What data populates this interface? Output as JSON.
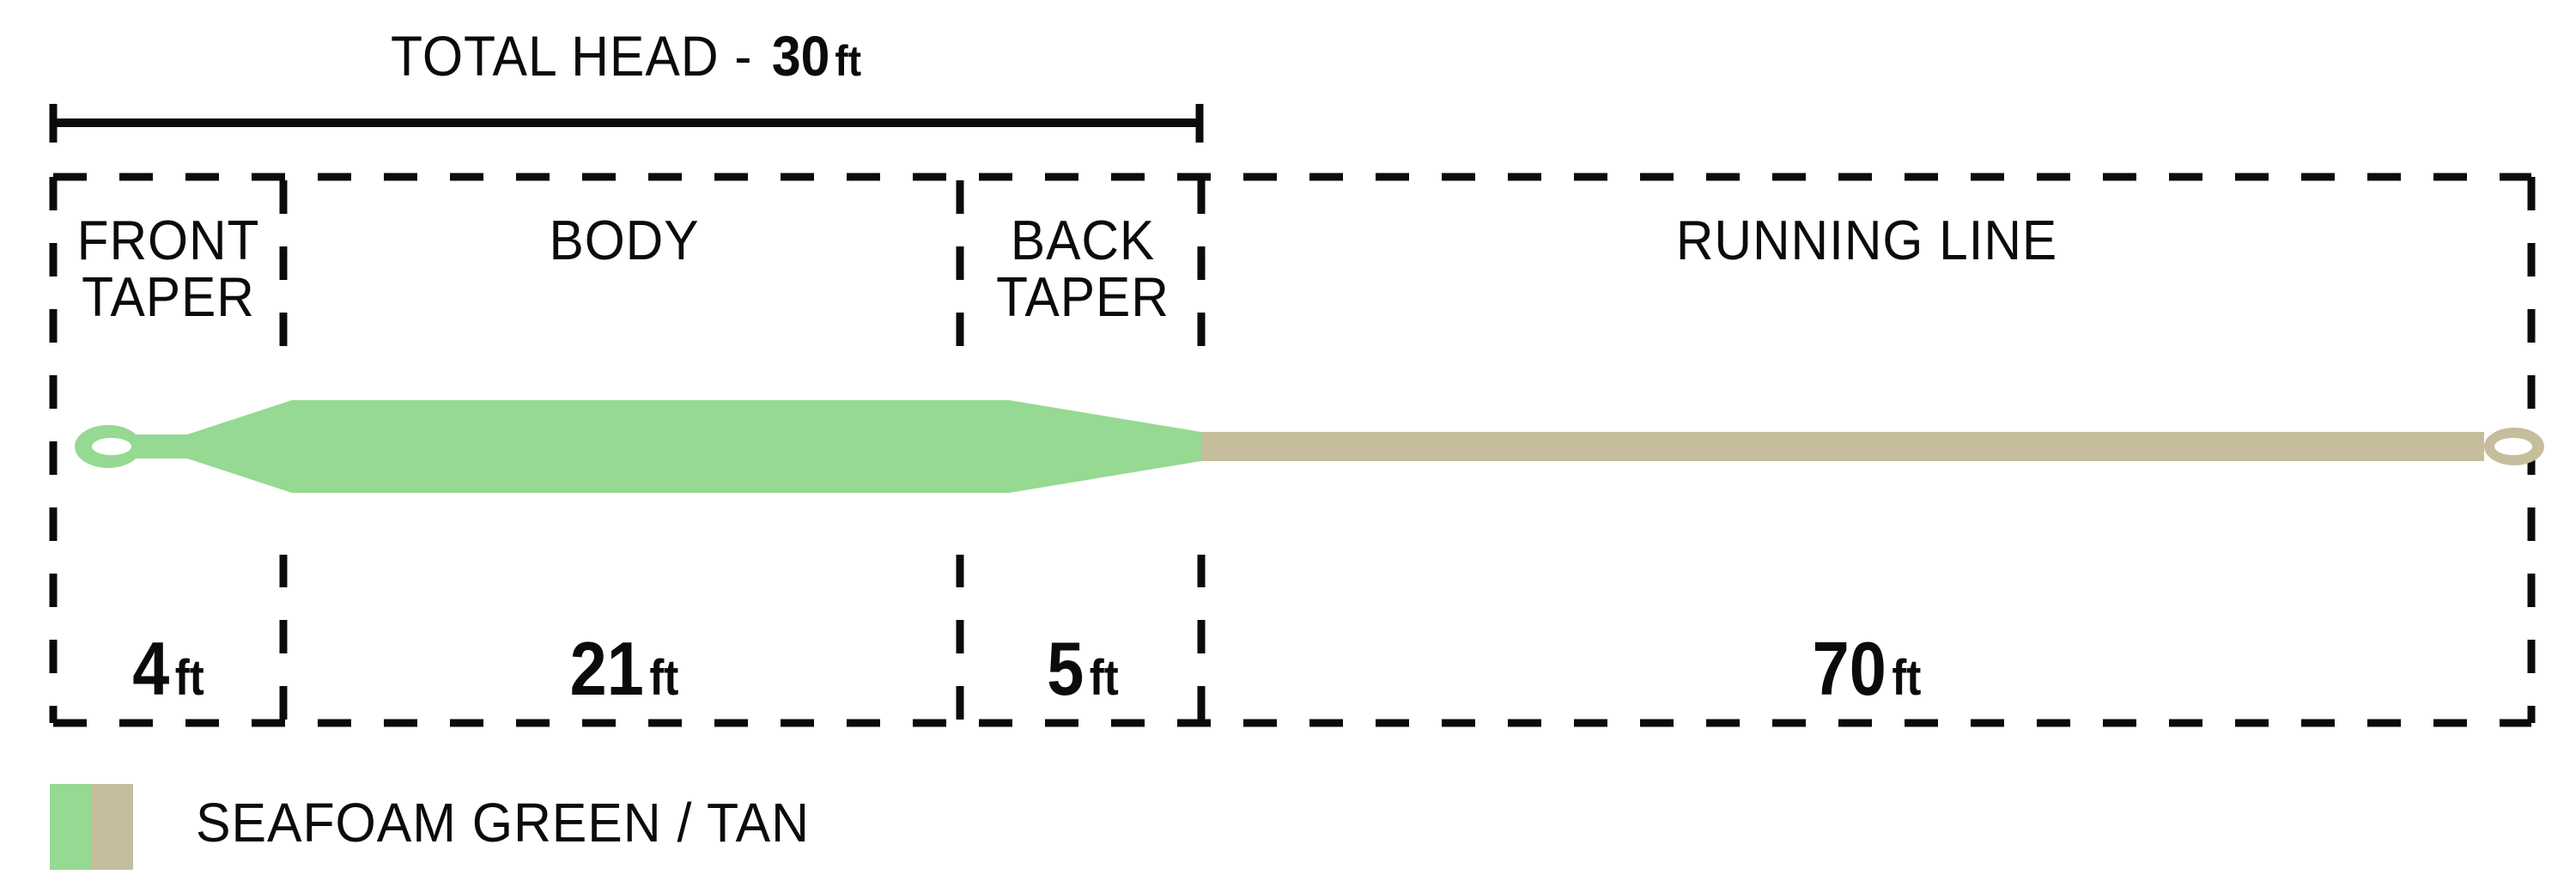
{
  "diagram": {
    "title": {
      "prefix": "TOTAL HEAD -",
      "value": "30",
      "unit": "ft"
    },
    "sections": [
      {
        "id": "front-taper",
        "label_line1": "FRONT",
        "label_line2": "TAPER",
        "length_value": "4",
        "length_unit": "ft"
      },
      {
        "id": "body",
        "label_line1": "BODY",
        "label_line2": "",
        "length_value": "21",
        "length_unit": "ft"
      },
      {
        "id": "back-taper",
        "label_line1": "BACK",
        "label_line2": "TAPER",
        "length_value": "5",
        "length_unit": "ft"
      },
      {
        "id": "running-line",
        "label_line1": "RUNNING LINE",
        "label_line2": "",
        "length_value": "70",
        "length_unit": "ft"
      }
    ],
    "head_sections_total_ft": "30",
    "legend": {
      "label": "SEAFOAM GREEN / TAN"
    },
    "colors": {
      "head_green": "#96D992",
      "running_tan": "#C6BD9C",
      "ink": "#0b0b0b",
      "hole_white": "#ffffff"
    }
  }
}
